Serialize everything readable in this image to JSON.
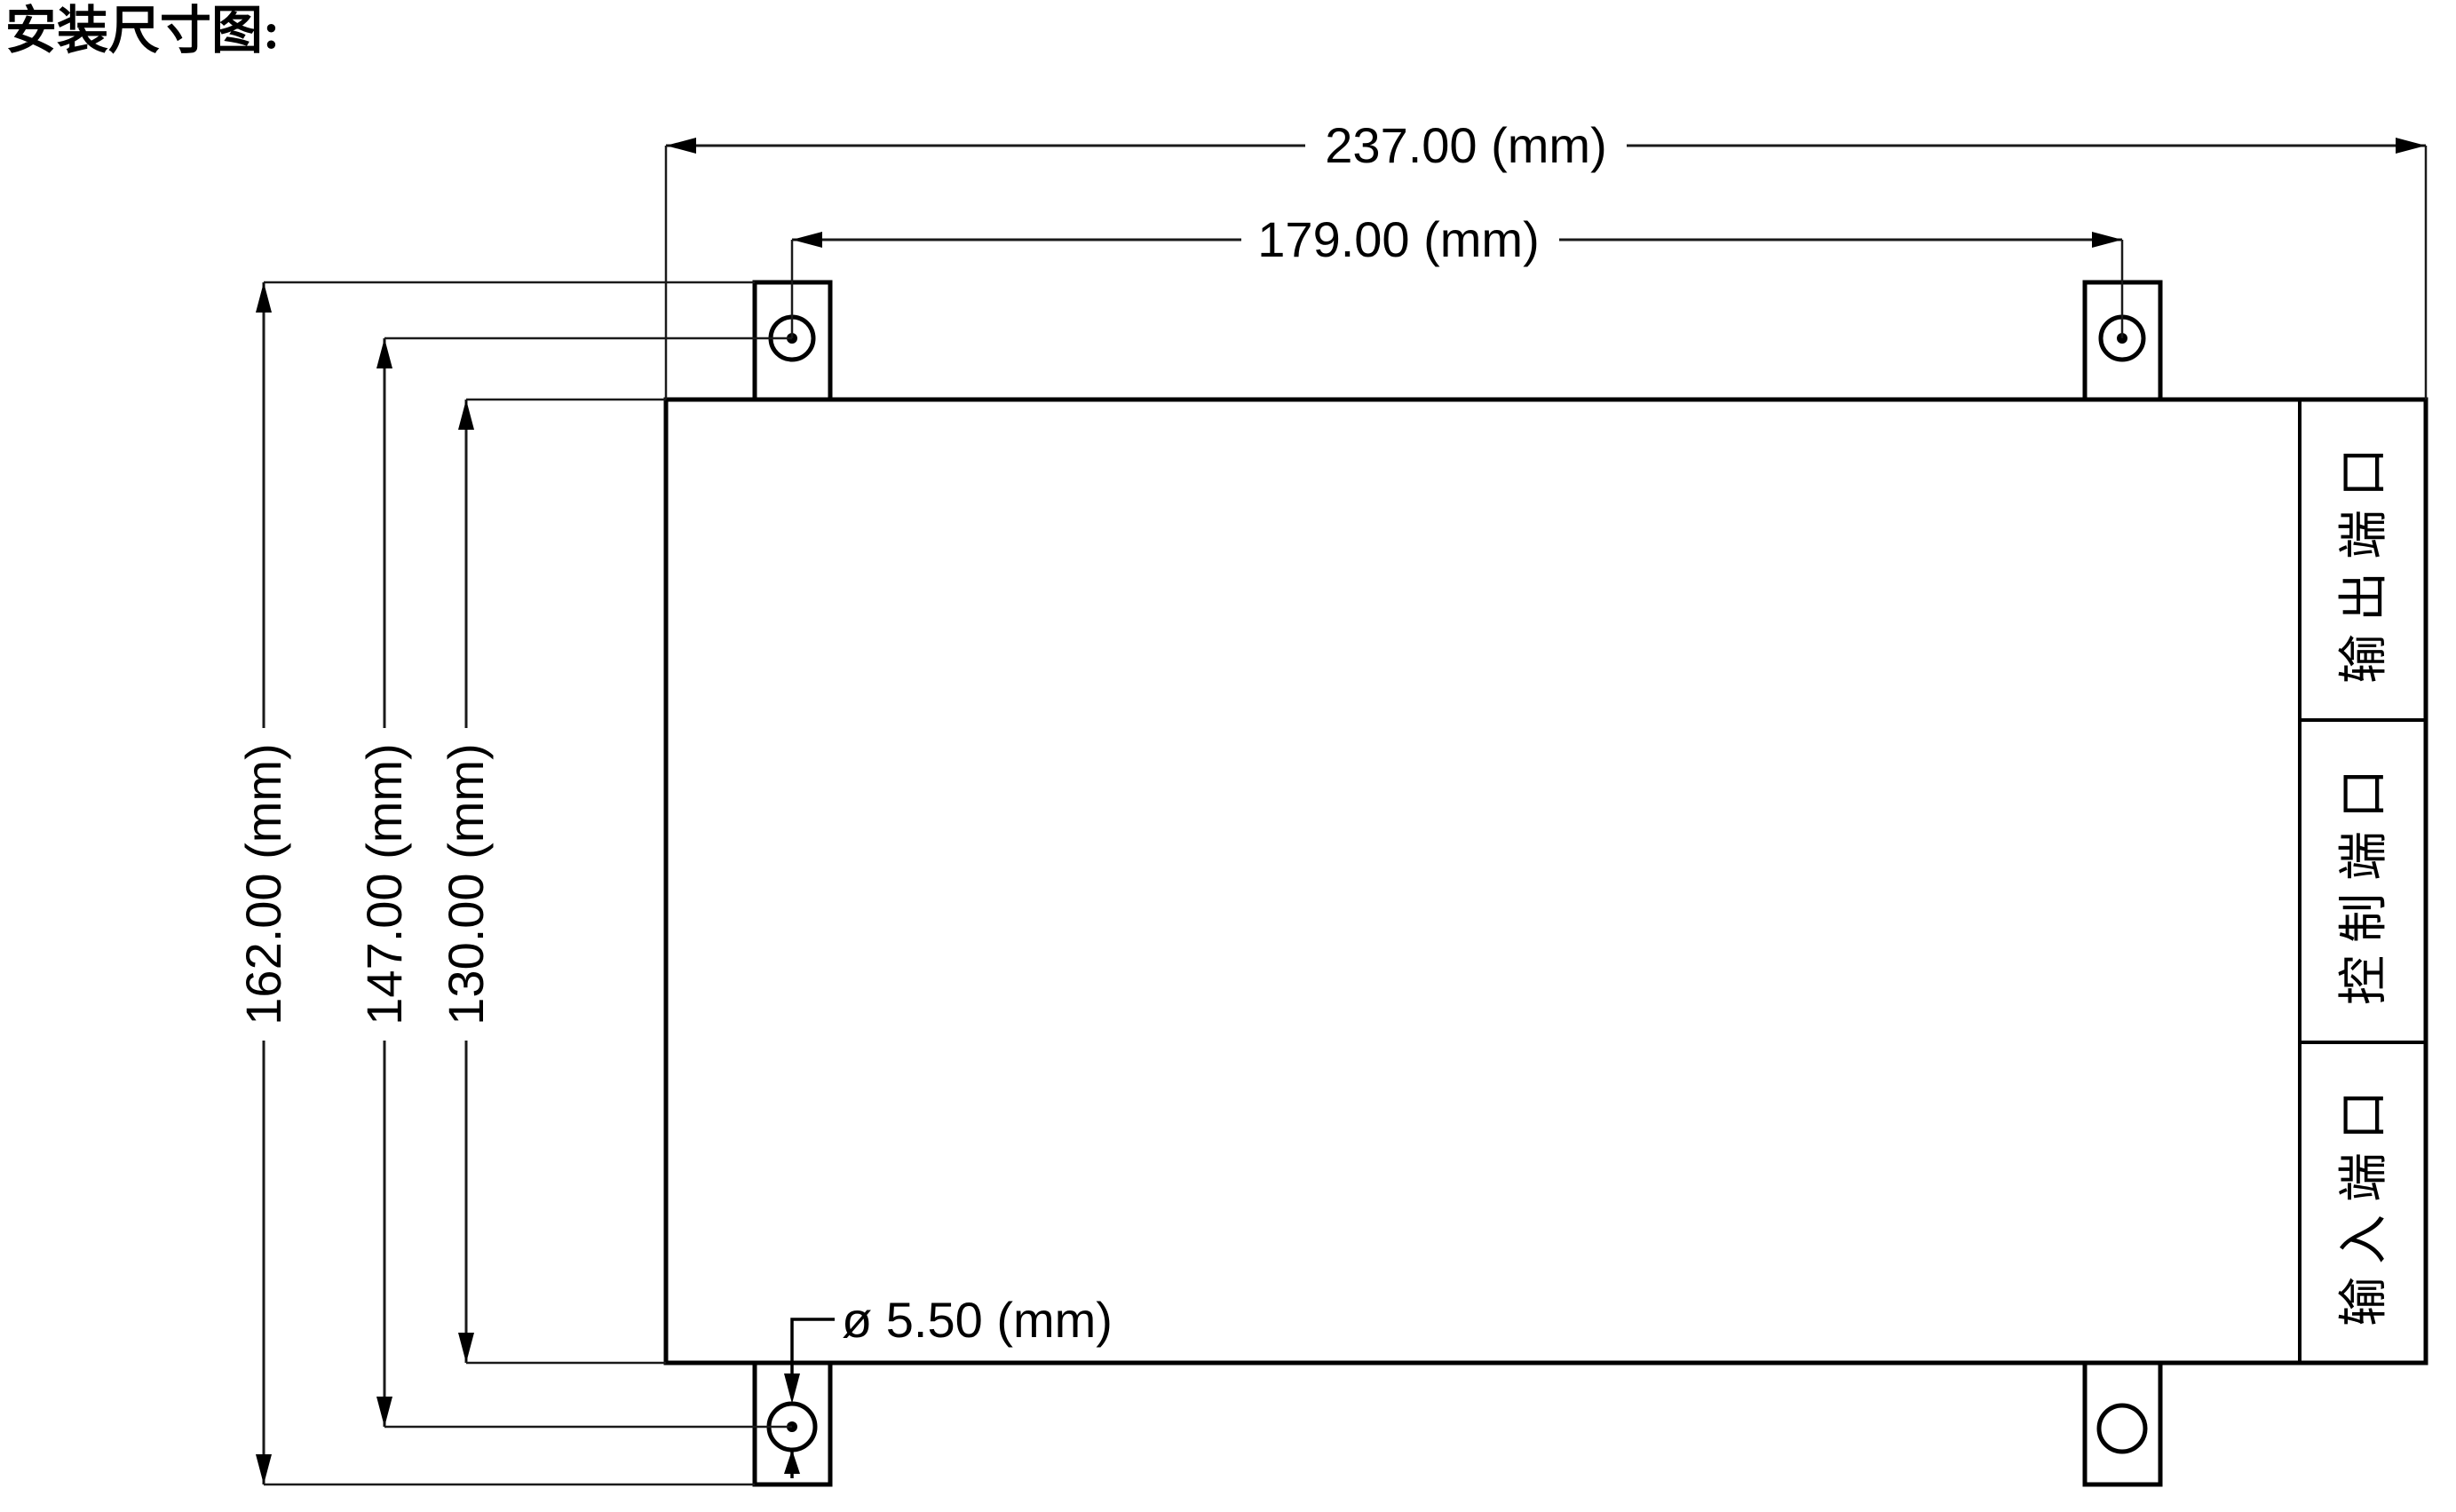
{
  "page": {
    "title": "安装尺寸图:"
  },
  "drawing": {
    "background_color": "#ffffff",
    "line_color": "#000000",
    "unit": "mm",
    "device": {
      "ports": [
        {
          "id": "output-port",
          "label": "输出端口"
        },
        {
          "id": "control-port",
          "label": "控制端口"
        },
        {
          "id": "input-port",
          "label": "输入端口"
        }
      ],
      "mounting_holes": 4
    },
    "dimensions": {
      "overall_width": {
        "label": "237.00 (mm)",
        "value_mm": 237.0
      },
      "hole_spacing_x": {
        "label": "179.00 (mm)",
        "value_mm": 179.0
      },
      "overall_height": {
        "label": "162.00 (mm)",
        "value_mm": 162.0
      },
      "hole_spacing_y": {
        "label": "147.00 (mm)",
        "value_mm": 147.0
      },
      "body_height": {
        "label": "130.00 (mm)",
        "value_mm": 130.0
      },
      "hole_diameter": {
        "label": "ø 5.50 (mm)",
        "value_mm": 5.5
      }
    }
  }
}
